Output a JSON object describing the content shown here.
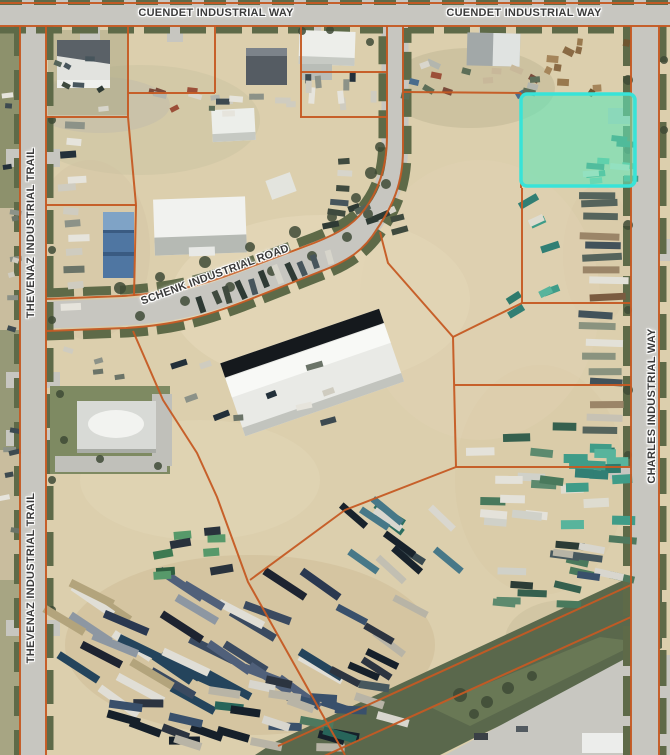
{
  "map": {
    "labels": [
      {
        "text": "CUENDET INDUSTRIAL WAY"
      },
      {
        "text": "CUENDET INDUSTRIAL WAY"
      },
      {
        "text": "THEVENAZ INDUSTRIAL TRAIL"
      },
      {
        "text": "THEVENAZ INDUSTRIAL TRAIL"
      },
      {
        "text": "SCHENK INDUSTRIAL ROAD"
      },
      {
        "text": "CHARLES INDUSTRIAL WAY"
      }
    ]
  },
  "colors": {
    "parcel_line": "#c55a23",
    "highlight_fill": "#66e3b6",
    "highlight_border": "#38e3d8",
    "road": "#c7c6c0",
    "dirt": "#dccfad"
  }
}
